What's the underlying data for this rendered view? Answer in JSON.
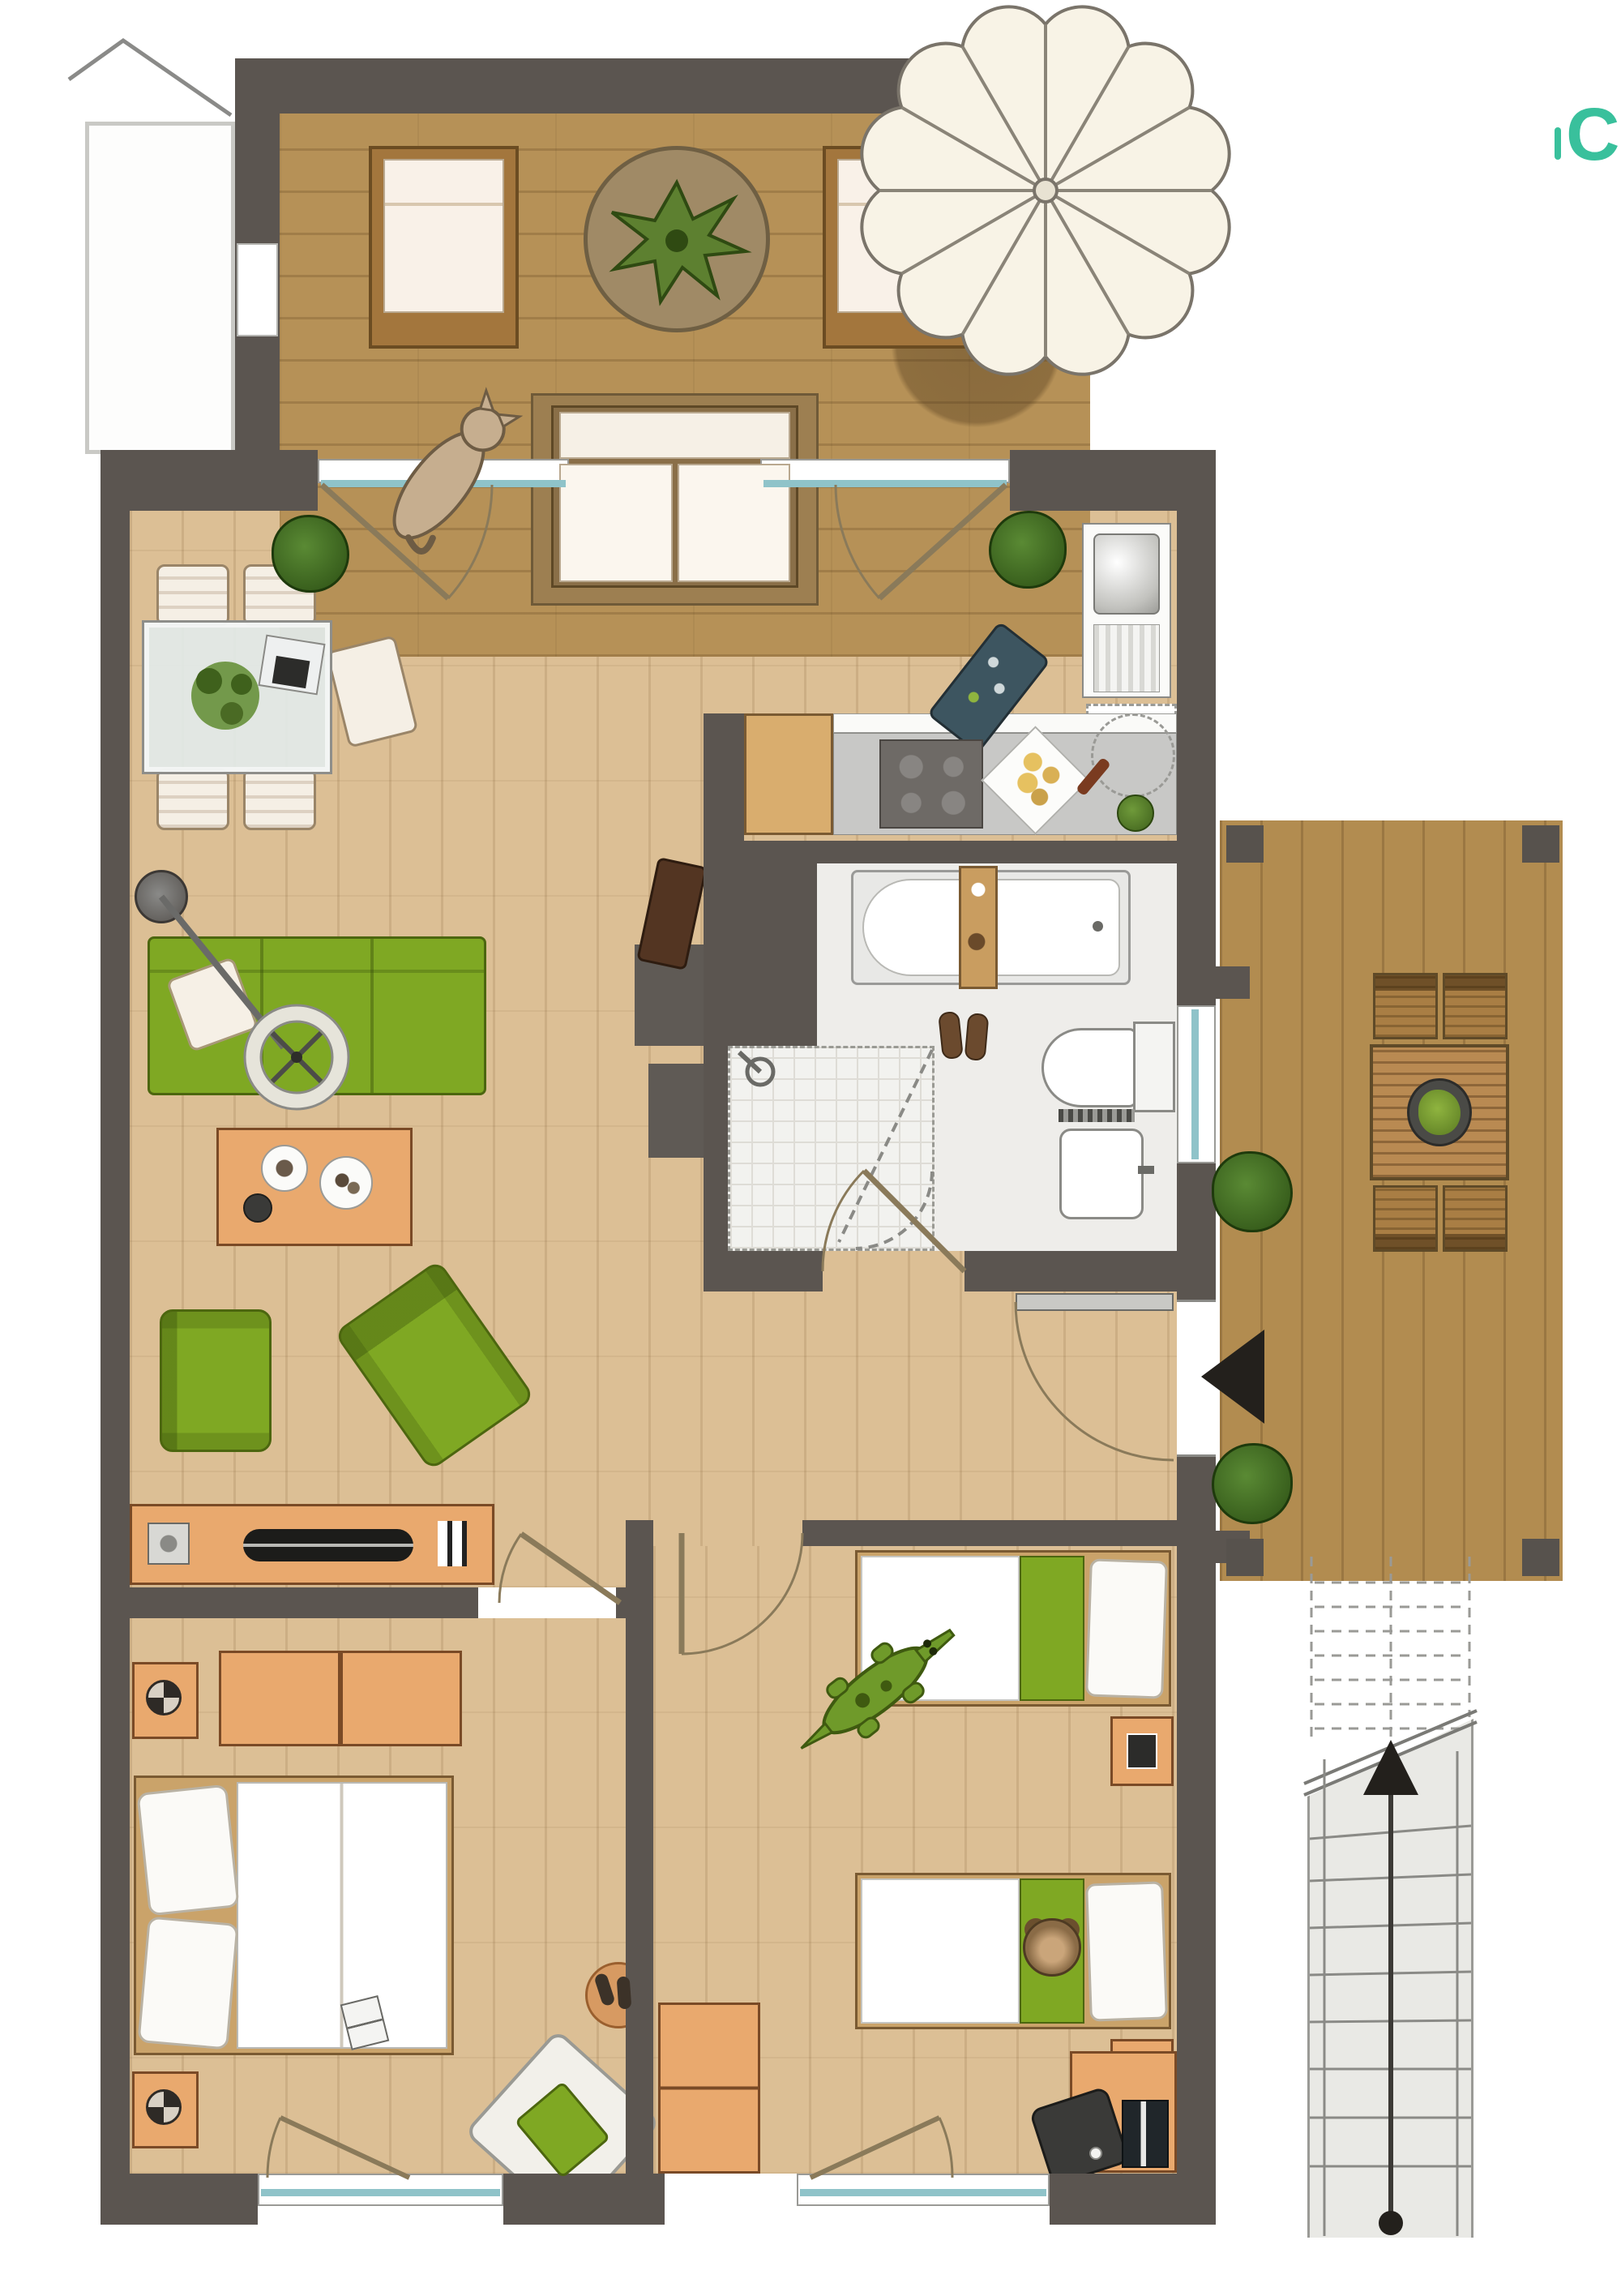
{
  "logo": {
    "text": "C"
  },
  "colors": {
    "wall": "#5b5550",
    "wood_floor": "#dcbf95",
    "terrace_deck": "#b69157",
    "side_deck": "#b28c50",
    "green_furniture": "#7fa823",
    "orange_furniture": "#e9a96e",
    "glass_teal": "#8fc3c9",
    "bath_floor": "#eeedea",
    "counter_gray": "#c8c8c6",
    "logo_teal": "#39c09c"
  },
  "plan": {
    "type": "apartment-floorplan",
    "rooms": [
      {
        "name": "terrace-top",
        "furniture": [
          "sun-lounger",
          "sun-lounger",
          "round-rug-with-plant",
          "outdoor-sofa",
          "cat",
          "parasol",
          "potted-plant",
          "potted-plant"
        ]
      },
      {
        "name": "living-room",
        "furniture": [
          "dining-table",
          "dining-chairs-x5",
          "table-plant",
          "laptop",
          "arc-floor-lamp",
          "green-sofa",
          "white-pillow",
          "coffee-table",
          "green-armchair",
          "green-armchair",
          "tv-sideboard",
          "dark-cabinet-blocks",
          "notebook-on-floor",
          "bag-on-floor"
        ]
      },
      {
        "name": "kitchen",
        "furniture": [
          "sink-unit",
          "dishwasher-dashed",
          "cooktop",
          "wood-worktop",
          "plate-of-food",
          "corkscrew",
          "herb-pot"
        ]
      },
      {
        "name": "bathroom",
        "furniture": [
          "bathtub",
          "tub-tray",
          "shower",
          "shower-head",
          "toilet",
          "wash-basin",
          "towel-radiator",
          "slippers"
        ]
      },
      {
        "name": "hallway",
        "furniture": [
          "entrance-door",
          "entrance-marker-triangle"
        ]
      },
      {
        "name": "bedroom-master",
        "furniture": [
          "double-bed",
          "pillows",
          "nightstand",
          "nightstand",
          "dresser",
          "round-rug",
          "slippers",
          "armchair-green-cushion",
          "book"
        ]
      },
      {
        "name": "bedroom-kids",
        "furniture": [
          "single-bed",
          "single-bed",
          "teddy-bear",
          "crocodile-toy",
          "nightstand",
          "nightstand",
          "wardrobe",
          "desk",
          "desk-chair",
          "laptop"
        ]
      },
      {
        "name": "deck-right",
        "furniture": [
          "slatted-table",
          "planter",
          "deck-chairs-x4",
          "bush",
          "bush",
          "corner-posts"
        ]
      },
      {
        "name": "stairs-outside",
        "furniture": [
          "upper-flight-dashed",
          "break-line",
          "lower-flight",
          "walk-line-arrow"
        ]
      }
    ]
  }
}
